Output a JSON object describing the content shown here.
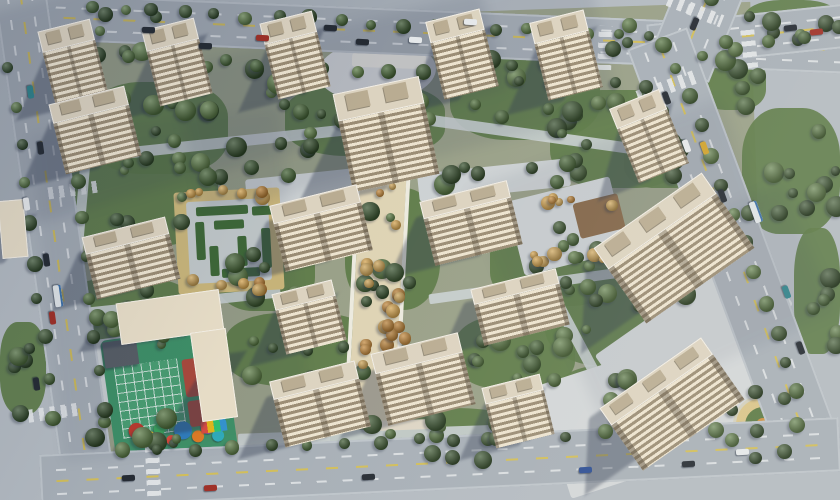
{
  "meta": {
    "title": "Aerial rendering of a residential complex master plan",
    "canvas_w": 840,
    "canvas_h": 500
  },
  "palette": {
    "bg": "#b3bac1",
    "site": "#99a088",
    "lawn": "#5c7946",
    "road": "#a7afb7",
    "pavement": "#d2d6d8",
    "pathlight": "#cad0d3",
    "tanpave": "#d3bd7d",
    "axis": "#ded3b4",
    "hedge": "#3f6a35",
    "shadow": "rgba(44,54,75,0.38)",
    "greens": [
      "#35502c",
      "#426133",
      "#4e6e3a",
      "#3a552f",
      "#5a7a44",
      "#2f4827"
    ],
    "oranges": [
      "#c08538",
      "#d2a04a",
      "#b37a30",
      "#caa052"
    ],
    "carColors": {
      "dark": "#252b33",
      "white": "#e5e8ea",
      "red": "#9e2f26",
      "teal": "#2e8089",
      "yellow": "#cfa22e",
      "blue": "#2a4c93",
      "green": "#3f7f4f",
      "bus": "#dde2e5"
    }
  },
  "seed": 20240901,
  "site": {
    "x": 58,
    "y": 14,
    "w": 700,
    "h": 432,
    "rot": -2
  },
  "roads": [
    {
      "name": "road-top",
      "x": -15,
      "y": 10,
      "w": 880,
      "h": 46,
      "rot": 2.4,
      "vert": false
    },
    {
      "name": "road-top-east",
      "x": 648,
      "y": 14,
      "w": 200,
      "h": 44,
      "rot": -6,
      "vert": false
    },
    {
      "name": "road-north-stub",
      "x": 664,
      "y": -26,
      "w": 66,
      "h": 100,
      "rot": 22,
      "vert": true
    },
    {
      "name": "road-right",
      "x": 517,
      "y": 208,
      "w": 430,
      "h": 64,
      "rot": 69.6,
      "vert": false
    },
    {
      "name": "road-left",
      "x": -205,
      "y": 214,
      "w": 520,
      "h": 52,
      "rot": 82,
      "vert": false
    },
    {
      "name": "road-bottom",
      "x": 40,
      "y": 436,
      "w": 800,
      "h": 54,
      "rot": -2.7,
      "vert": false
    }
  ],
  "crosswalks": [
    {
      "x": 598,
      "y": 26,
      "w": 14,
      "h": 44,
      "rot": 2.4,
      "dir": "h"
    },
    {
      "x": 742,
      "y": 26,
      "w": 14,
      "h": 42,
      "rot": -6,
      "dir": "h"
    },
    {
      "x": 666,
      "y": 4,
      "w": 58,
      "h": 13,
      "rot": 22,
      "dir": "v"
    },
    {
      "x": 636,
      "y": 80,
      "w": 62,
      "h": 14,
      "rot": -20,
      "dir": "v"
    },
    {
      "x": 28,
      "y": 406,
      "w": 54,
      "h": 13,
      "rot": -8,
      "dir": "v"
    },
    {
      "x": 146,
      "y": 444,
      "w": 14,
      "h": 52,
      "rot": -2.7,
      "dir": "h"
    },
    {
      "x": 48,
      "y": 184,
      "w": 50,
      "h": 12,
      "rot": -8,
      "dir": "v"
    },
    {
      "x": 282,
      "y": 28,
      "w": 13,
      "h": 46,
      "rot": 2.4,
      "dir": "h"
    }
  ],
  "lawns": [
    [
      88,
      82,
      140,
      92
    ],
    [
      285,
      84,
      160,
      72
    ],
    [
      450,
      48,
      150,
      92
    ],
    [
      550,
      90,
      140,
      98
    ],
    [
      58,
      148,
      160,
      98
    ],
    [
      58,
      278,
      140,
      78
    ],
    [
      215,
      223,
      100,
      88
    ],
    [
      345,
      188,
      95,
      122
    ],
    [
      490,
      218,
      130,
      88
    ],
    [
      545,
      268,
      150,
      98
    ],
    [
      225,
      313,
      150,
      73
    ],
    [
      330,
      408,
      200,
      52
    ],
    [
      455,
      316,
      120,
      73
    ],
    [
      0,
      322,
      46,
      92
    ],
    [
      556,
      366,
      110,
      68
    ],
    [
      700,
      56,
      66,
      54
    ],
    [
      742,
      108,
      98,
      126
    ],
    [
      794,
      228,
      46,
      126
    ],
    [
      744,
      0,
      96,
      46
    ],
    [
      624,
      130,
      80,
      58
    ]
  ],
  "paths": [
    {
      "x": 86,
      "y": 138,
      "w": 262,
      "h": 11,
      "rot": -6
    },
    {
      "x": 426,
      "y": 130,
      "w": 225,
      "h": 11,
      "rot": 8
    },
    {
      "x": 76,
      "y": 298,
      "w": 205,
      "h": 10,
      "rot": -6
    },
    {
      "x": 70,
      "y": 150,
      "w": 10,
      "h": 262,
      "rot": 5
    },
    {
      "x": 428,
      "y": 278,
      "w": 235,
      "h": 10,
      "rot": -8
    },
    {
      "x": 548,
      "y": 178,
      "w": 11,
      "h": 235,
      "rot": -28
    },
    {
      "x": 238,
      "y": 428,
      "w": 335,
      "h": 12,
      "rot": -2
    },
    {
      "x": 600,
      "y": 326,
      "w": 185,
      "h": 12,
      "rot": -22
    }
  ],
  "pavements": [
    {
      "x": 318,
      "y": 40,
      "w": 118,
      "h": 62,
      "rot": -3,
      "c": "#d8dbdd",
      "r": "50%"
    },
    {
      "x": 246,
      "y": 172,
      "w": 146,
      "h": 28,
      "rot": -6,
      "c": "#ccd1d3"
    },
    {
      "x": 418,
      "y": 166,
      "w": 152,
      "h": 28,
      "rot": -6,
      "c": "#ccd1d3"
    },
    {
      "x": 548,
      "y": 350,
      "w": 218,
      "h": 118,
      "rot": -18,
      "c": "#d2d6d8"
    },
    {
      "x": 598,
      "y": 294,
      "w": 192,
      "h": 72,
      "rot": -35,
      "c": "#d2d6d8"
    },
    {
      "x": 92,
      "y": 338,
      "w": 42,
      "h": 84,
      "rot": -8,
      "c": "#cdd2d4"
    },
    {
      "x": 514,
      "y": 188,
      "w": 106,
      "h": 76,
      "rot": -14,
      "c": "#d3d7d9"
    },
    {
      "x": 576,
      "y": 198,
      "w": 46,
      "h": 36,
      "rot": -14,
      "c": "#8a6a4a"
    },
    {
      "x": 356,
      "y": 96,
      "w": 46,
      "h": 332,
      "rot": 3,
      "c": "#ded3b4"
    },
    {
      "x": 352,
      "y": 96,
      "w": 4,
      "h": 330,
      "rot": 3,
      "c": "#eceadf"
    },
    {
      "x": 402,
      "y": 96,
      "w": 4,
      "h": 330,
      "rot": 3,
      "c": "#eceadf"
    },
    {
      "x": 176,
      "y": 190,
      "w": 106,
      "h": 102,
      "rot": -3,
      "c": "#d3bd7d"
    },
    {
      "x": 188,
      "y": 200,
      "w": 82,
      "h": 82,
      "rot": -3,
      "c": "#c9d0d0"
    },
    {
      "x": 352,
      "y": 54,
      "w": 74,
      "h": 14,
      "rot": 2,
      "c": "#e9e7e1"
    },
    {
      "x": 370,
      "y": 420,
      "w": 64,
      "h": 10,
      "rot": -2,
      "c": "#ddd5c4"
    }
  ],
  "hedges": [
    [
      196,
      206,
      52,
      9
    ],
    [
      196,
      222,
      9,
      38
    ],
    [
      214,
      220,
      30,
      9
    ],
    [
      238,
      236,
      9,
      30
    ],
    [
      210,
      246,
      9,
      30
    ],
    [
      222,
      268,
      38,
      9
    ],
    [
      252,
      206,
      22,
      9
    ],
    [
      262,
      228,
      9,
      40
    ]
  ],
  "playground": {
    "x": 108,
    "y": 332,
    "w": 122,
    "h": 126,
    "rot": -8,
    "base": "#3f9468",
    "grid": {
      "x": 10,
      "y": 28,
      "w": 64,
      "h": 72
    },
    "red": [
      {
        "x": 78,
        "y": 30,
        "w": 20,
        "h": 38
      },
      {
        "x": 78,
        "y": 72,
        "w": 20,
        "h": 26
      }
    ],
    "dark": {
      "x": 2,
      "y": 2,
      "w": 34,
      "h": 26,
      "c": "#585f66"
    },
    "items": [
      {
        "x": 24,
        "y": 94,
        "r": 8,
        "c": "#c0392b"
      },
      {
        "x": 36,
        "y": 102,
        "r": 6,
        "c": "#e0b62a"
      },
      {
        "x": 47,
        "y": 95,
        "r": 6,
        "c": "#3aa65c"
      },
      {
        "x": 70,
        "y": 100,
        "r": 9,
        "c": "#2f7fc1"
      },
      {
        "x": 84,
        "y": 108,
        "r": 6,
        "c": "#e67e22"
      },
      {
        "x": 95,
        "y": 100,
        "r": 7,
        "c": "#8e44ad"
      },
      {
        "x": 57,
        "y": 108,
        "r": 5,
        "c": "#e74c3c"
      },
      {
        "x": 104,
        "y": 110,
        "r": 6,
        "c": "#2fb1c1"
      }
    ],
    "rainbow": {
      "x": 88,
      "y": 92,
      "w": 26,
      "h": 14
    }
  },
  "circleGarden": {
    "cx": 763,
    "cy": 425,
    "r": 21,
    "ring": "#d9c489",
    "inner": "#5c7a45",
    "core": "#cf9040",
    "treeR": 34,
    "treeN": 7
  },
  "buildings": [
    [
      46,
      24,
      54,
      78,
      -14,
      0
    ],
    [
      150,
      23,
      54,
      78,
      -14,
      0
    ],
    [
      268,
      16,
      54,
      78,
      -14,
      0
    ],
    [
      434,
      14,
      56,
      80,
      -14,
      0
    ],
    [
      538,
      15,
      56,
      80,
      -14,
      0
    ],
    [
      622,
      96,
      54,
      80,
      -22,
      0
    ],
    [
      56,
      94,
      78,
      72,
      -14,
      0
    ],
    [
      88,
      226,
      86,
      64,
      -14,
      0
    ],
    [
      342,
      84,
      88,
      100,
      -12,
      0
    ],
    [
      276,
      194,
      90,
      68,
      -14,
      0
    ],
    [
      426,
      190,
      90,
      66,
      -14,
      0
    ],
    [
      608,
      202,
      132,
      92,
      -35,
      0
    ],
    [
      278,
      286,
      62,
      62,
      -14,
      0
    ],
    [
      476,
      278,
      88,
      58,
      -14,
      0
    ],
    [
      276,
      370,
      88,
      68,
      -14,
      0
    ],
    [
      378,
      342,
      90,
      74,
      -14,
      0
    ],
    [
      488,
      380,
      60,
      62,
      -14,
      0
    ],
    [
      610,
      366,
      124,
      76,
      -35,
      0
    ],
    [
      118,
      296,
      104,
      42,
      -8,
      1
    ],
    [
      196,
      330,
      36,
      90,
      -8,
      1
    ],
    [
      0,
      200,
      26,
      58,
      -5,
      1
    ]
  ],
  "treeClusters": [
    [
      96,
      88,
      118,
      72,
      13
    ],
    [
      205,
      55,
      100,
      58,
      9
    ],
    [
      298,
      92,
      138,
      58,
      11
    ],
    [
      462,
      56,
      128,
      78,
      13
    ],
    [
      562,
      98,
      118,
      84,
      13
    ],
    [
      96,
      158,
      108,
      68,
      9
    ],
    [
      75,
      288,
      108,
      58,
      9
    ],
    [
      227,
      233,
      78,
      68,
      7
    ],
    [
      357,
      193,
      68,
      112,
      9
    ],
    [
      500,
      226,
      108,
      68,
      9
    ],
    [
      562,
      276,
      128,
      84,
      13
    ],
    [
      240,
      323,
      128,
      58,
      11
    ],
    [
      347,
      416,
      168,
      44,
      11
    ],
    [
      472,
      323,
      98,
      58,
      9
    ],
    [
      567,
      373,
      88,
      54,
      7
    ],
    [
      206,
      140,
      118,
      38,
      7
    ],
    [
      432,
      150,
      138,
      38,
      7
    ],
    [
      94,
      416,
      118,
      34,
      7
    ],
    [
      612,
      25,
      58,
      33,
      4
    ],
    [
      700,
      60,
      62,
      48,
      5
    ],
    [
      745,
      112,
      92,
      118,
      11
    ],
    [
      797,
      232,
      42,
      118,
      6
    ],
    [
      0,
      328,
      42,
      86,
      5
    ],
    [
      748,
      2,
      90,
      42,
      6
    ],
    [
      628,
      136,
      72,
      52,
      6
    ],
    [
      90,
      14,
      70,
      40,
      5
    ]
  ],
  "orangeClusters": [
    [
      360,
      106,
      40,
      296,
      22
    ],
    [
      182,
      190,
      98,
      12,
      6
    ],
    [
      182,
      278,
      98,
      12,
      6
    ],
    [
      520,
      194,
      92,
      12,
      6
    ],
    [
      520,
      250,
      92,
      12,
      6
    ],
    [
      384,
      298,
      34,
      78,
      5
    ]
  ],
  "roadTreeLines": [
    [
      92,
      8,
      652,
      38,
      19
    ],
    [
      96,
      54,
      648,
      86,
      18
    ],
    [
      678,
      66,
      798,
      392,
      12
    ],
    [
      700,
      54,
      836,
      28,
      5
    ],
    [
      10,
      70,
      54,
      416,
      10
    ],
    [
      62,
      64,
      104,
      412,
      10
    ],
    [
      122,
      450,
      754,
      428,
      18
    ],
    [
      714,
      2,
      728,
      40,
      2
    ]
  ],
  "softShadows": [
    [
      -70,
      -45,
      560,
      215,
      -16,
      0.12
    ],
    [
      180,
      15,
      430,
      150,
      -14,
      0.1
    ],
    [
      480,
      140,
      270,
      120,
      -20,
      0.08
    ],
    [
      46,
      120,
      250,
      330,
      -6,
      0.07
    ],
    [
      560,
      230,
      260,
      140,
      -24,
      0.08
    ]
  ],
  "cars": [
    [
      30,
      92,
      82,
      "teal"
    ],
    [
      40,
      148,
      82,
      "dark"
    ],
    [
      26,
      204,
      82,
      "white"
    ],
    [
      46,
      260,
      82,
      "dark"
    ],
    [
      52,
      318,
      82,
      "red"
    ],
    [
      36,
      384,
      82,
      "dark"
    ],
    [
      58,
      296,
      82,
      "bus"
    ],
    [
      148,
      30,
      2,
      "dark"
    ],
    [
      205,
      46,
      2,
      "dark"
    ],
    [
      262,
      38,
      3,
      "red"
    ],
    [
      330,
      28,
      3,
      "dark"
    ],
    [
      362,
      42,
      3,
      "dark"
    ],
    [
      415,
      40,
      3,
      "white"
    ],
    [
      470,
      22,
      3,
      "white"
    ],
    [
      790,
      28,
      -6,
      "dark"
    ],
    [
      816,
      32,
      -6,
      "red"
    ],
    [
      694,
      24,
      112,
      "dark"
    ],
    [
      666,
      98,
      70,
      "dark"
    ],
    [
      686,
      146,
      70,
      "white"
    ],
    [
      704,
      148,
      70,
      "yellow"
    ],
    [
      722,
      196,
      70,
      "dark"
    ],
    [
      756,
      212,
      70,
      "bus"
    ],
    [
      786,
      292,
      70,
      "teal"
    ],
    [
      800,
      348,
      70,
      "dark"
    ],
    [
      128,
      478,
      -3,
      "dark"
    ],
    [
      210,
      488,
      -3,
      "red"
    ],
    [
      368,
      477,
      -3,
      "dark"
    ],
    [
      585,
      470,
      -3,
      "blue"
    ],
    [
      688,
      464,
      -3,
      "dark"
    ],
    [
      742,
      452,
      -3,
      "white"
    ]
  ]
}
